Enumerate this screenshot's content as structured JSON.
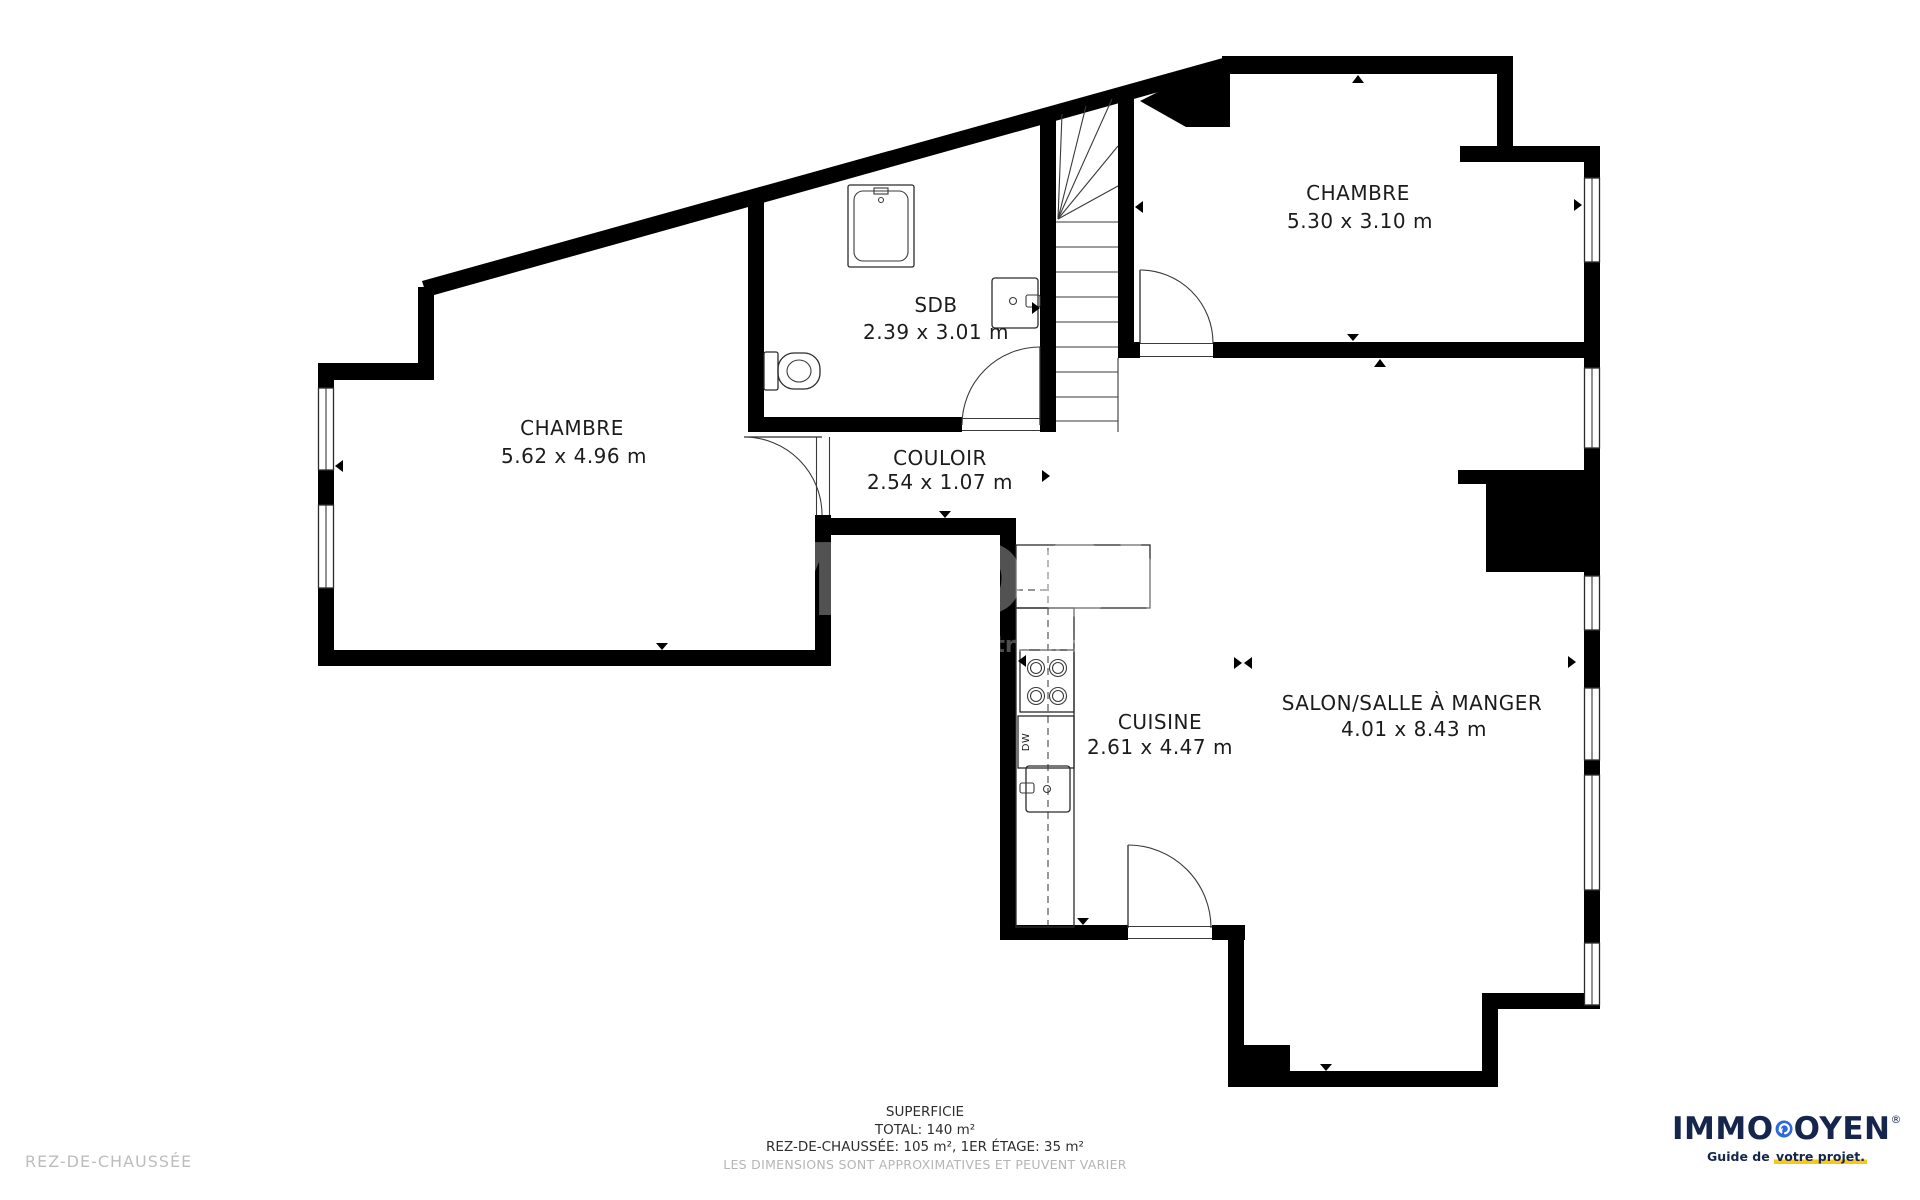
{
  "plan": {
    "rooms": {
      "chambre_left": {
        "name": "CHAMBRE",
        "dims": "5.62 x 4.96 m"
      },
      "chambre_right": {
        "name": "CHAMBRE",
        "dims": "5.30 x 3.10 m"
      },
      "sdb": {
        "name": "SDB",
        "dims": "2.39 x 3.01 m"
      },
      "couloir": {
        "name": "COULOIR",
        "dims": "2.54 x 1.07 m"
      },
      "cuisine": {
        "name": "CUISINE",
        "dims": "2.61 x 4.47 m"
      },
      "salon": {
        "name": "SALON/SALLE À MANGER",
        "dims": "4.01 x 8.43 m"
      }
    },
    "fixtures": {
      "dishwasher_label": "DW"
    }
  },
  "watermark": {
    "title": "IMMODOYEN",
    "tagline": "Guide de votre projet"
  },
  "footer": {
    "superficie_title": "SUPERFICIE",
    "total": "TOTAL: 140 m²",
    "breakdown": "REZ-DE-CHAUSSÉE: 105 m², 1ER ÉTAGE: 35 m²",
    "disclaimer": "LES DIMENSIONS SONT APPROXIMATIVES ET PEUVENT VARIER",
    "floor_label": "REZ-DE-CHAUSSÉE"
  },
  "logo": {
    "part1": "IMMO",
    "part2": "OYEN",
    "registered": "®",
    "tagline_prefix": "Guide de ",
    "tagline_highlight": "votre projet."
  },
  "colors": {
    "wall": "#000000",
    "line": "#2b2b2b",
    "label_text": "#1c1c1c",
    "muted_text": "#b5b5b5",
    "logo_navy": "#16254c",
    "logo_blue": "#2b6bd8",
    "highlight_yellow": "#f6c915"
  }
}
